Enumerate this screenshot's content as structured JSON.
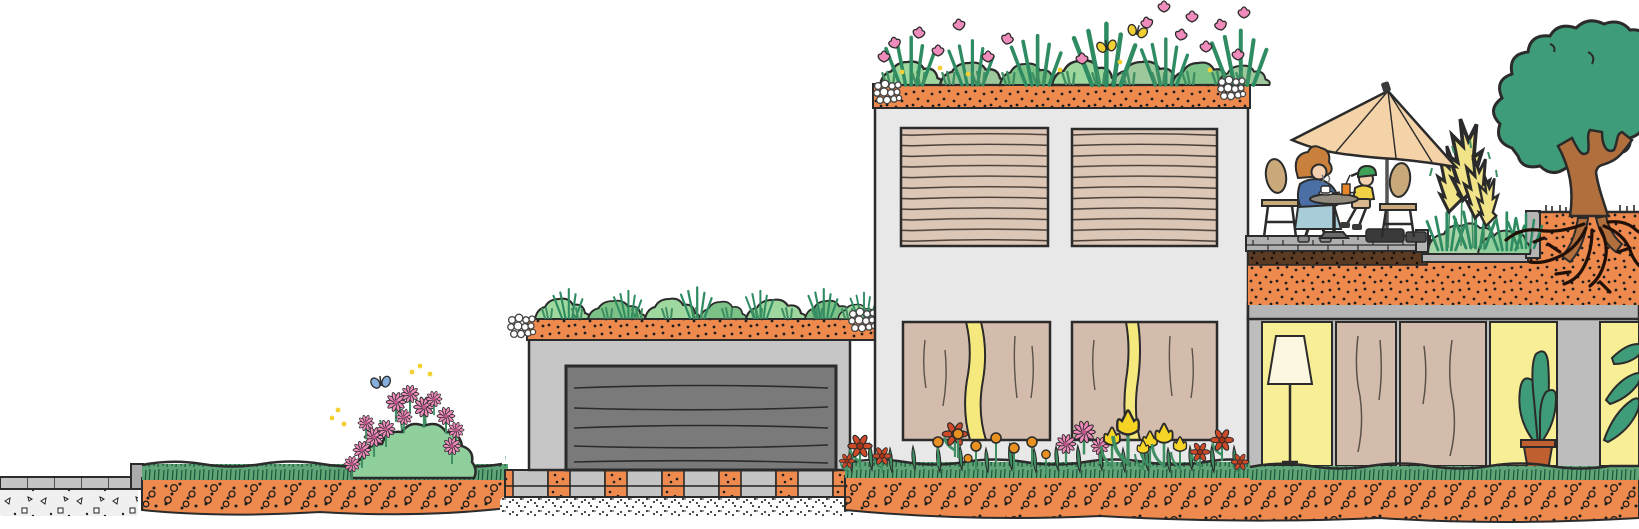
{
  "scene": {
    "type": "illustration",
    "subject": "hand-drawn cross-section of buildings with green roofs, roof terrace and soil layers",
    "elements": [
      "sidewalk-pavement",
      "lawn-strip",
      "soil-cross-section",
      "flowering-shrub",
      "blue-butterfly",
      "garage-with-green-roof",
      "garage-roller-door",
      "permeable-pavers-with-grass",
      "gravel-layer",
      "house-with-roof-garden",
      "roof-garden-flowers",
      "yellow-butterflies",
      "roller-blind-windows",
      "curtained-lit-windows",
      "flower-bed",
      "roof-terrace-deck",
      "parasol",
      "woman-at-table",
      "child-at-table",
      "bistro-table-with-coffee",
      "terrace-planter",
      "pampas-grass",
      "tree-with-exposed-roots",
      "raised-soil-bed",
      "indoor-room-with-floor-lamp",
      "indoor-curtains",
      "indoor-potted-plant"
    ],
    "counts": {
      "buildings": 3,
      "people": 2,
      "butterflies": 3,
      "upper_windows": 2,
      "lower_windows": 2
    }
  },
  "palette": {
    "ink": "#2b2b2b",
    "soil": "#EE8A4E",
    "grass": "#5FA578",
    "leaf": "#3F8F63",
    "darkGreen": "#2F8C62",
    "bushLight": "#9ED89E",
    "bushMid": "#7CC287",
    "sage": "#9CC89C",
    "treeGreen": "#3F9C78",
    "trunk": "#B06F3C",
    "bldgGrey": "#C6C6C6",
    "bldgLight": "#E8E8E8",
    "annexGrey": "#BDBDBD",
    "slabGrey": "#B5B5B5",
    "door": "#7A7A7A",
    "blind": "#DCC6B6",
    "curtain": "#D4BCAC",
    "winGlow": "#F5E97E",
    "roomYellow": "#F8EE96",
    "lampShade": "#FCF7E0",
    "pot": "#C06030",
    "umbrella": "#F4D3A8",
    "chairTan": "#C9A97A",
    "deck": "#B0B0B0",
    "brown": "#5A3A22",
    "pinkF": "#F08CBC",
    "redF": "#CC4A28",
    "redFdark": "#A33315",
    "orangeF": "#E89020",
    "tulip": "#F5D426",
    "pampas": "#F0E388",
    "butterY": "#F2D034",
    "butterB": "#85AEDC",
    "hair": "#C8803C",
    "skin": "#F2D0B0",
    "sweater": "#4A6FA5",
    "skirt": "#A9CCD9",
    "cap": "#3FA058",
    "shirt": "#F2D245",
    "paver": "#C4C4C4",
    "concrete": "#F0F0F0"
  }
}
